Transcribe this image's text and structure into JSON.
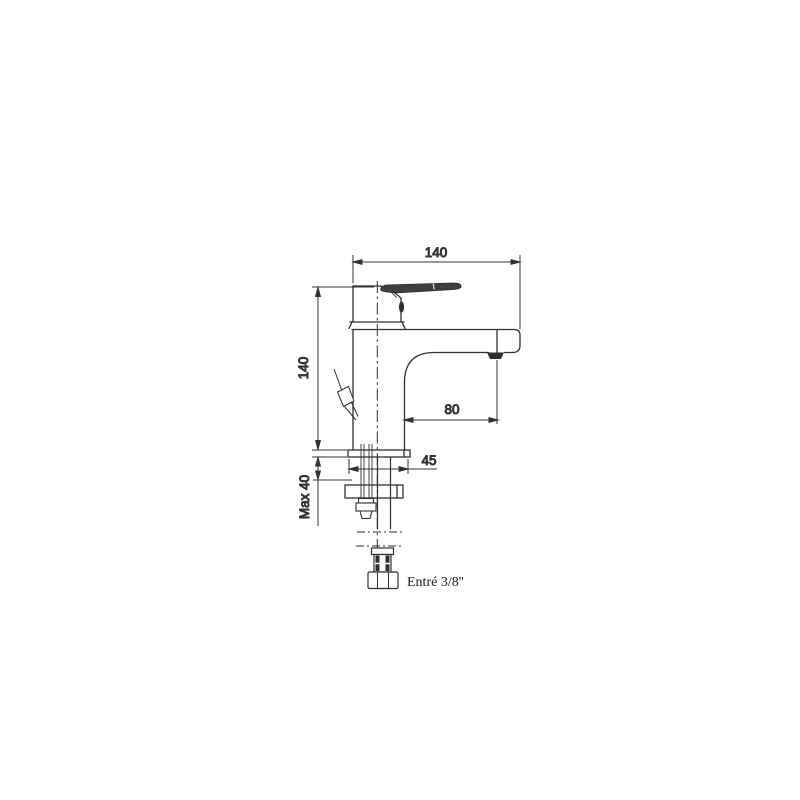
{
  "drawing": {
    "subject": "single-lever basin mixer tap, side elevation with installation parts",
    "background_color": "#ffffff",
    "line_color": "#2f2f2f",
    "dimension_color": "#333333",
    "dimensions": {
      "overall_width": "140",
      "overall_height": "140",
      "spout_projection": "80",
      "base_width": "45",
      "max_deck_thickness": "Max 40",
      "inlet_connection": "Entré 3/8''"
    }
  }
}
